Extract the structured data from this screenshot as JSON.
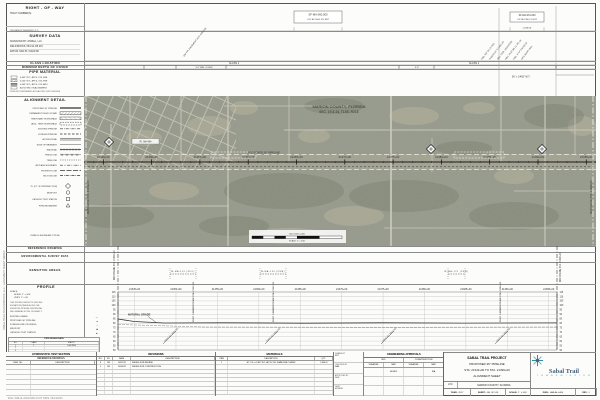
{
  "margin": {
    "left_note": "SABAL TRAIL TRANSMISSION, LLC  -  ALIGNMENT SHEET SERIES",
    "plot_note": "FILE: SAB-AL-0404.DWG    PLOT DATE: 09/14/2015"
  },
  "stations": [
    "21345+00",
    "21350+00",
    "21355+00",
    "21360+00",
    "21365+00",
    "21370+00",
    "21375+00",
    "21380+00",
    "21385+00",
    "21390+00",
    "21395+00"
  ],
  "header": {
    "row": {
      "title": "RIGHT - OF - WAY",
      "sub1": "TRACT NUMBER(S)",
      "sub2": "PERMANENT EASEMENT (FT.)",
      "tract1": "SF-MA-060.000",
      "or1": "O.R. BK 2044, PG 1857",
      "tract2": "SF-MA-061.000",
      "or2": "O.R. BK 1980, PG 0112",
      "dim": "1,318.50'"
    },
    "survey": {
      "title": "SURVEY DATA",
      "rows": [
        "SURVEYED BY: ATWELL, LLC",
        "FIELD BOOKS: FB 214, FB 215",
        "DATUM: NAD 83 / NAVD 88"
      ],
      "slants": [
        {
          "x": 100,
          "y": 54,
          "t": "100' FPL EASEMENT (O.R. 845/123)"
        },
        {
          "x": 398,
          "y": 57,
          "t": "FND. 5/8\" IR LS 7011"
        },
        {
          "x": 406,
          "y": 57,
          "t": "N 89°54'12\" E  2,651.20'"
        },
        {
          "x": 414,
          "y": 57,
          "t": "SEC. COR. 19/24/25/30"
        },
        {
          "x": 422,
          "y": 57,
          "t": "REC. PLAT BK 12, PG 34"
        },
        {
          "x": 430,
          "y": 57,
          "t": "FND. 4\"X4\" CM NO ID"
        },
        {
          "x": 438,
          "y": 57,
          "t": "GPS POINT 4041"
        }
      ],
      "rows_right": ""
    },
    "class_location": {
      "title": "CLASS LOCATION",
      "note": "CLASS 1"
    },
    "min_depth": {
      "title": "MINIMUM DEPTH OF COVER",
      "seg_label": "3'-0\" MIN. COVER",
      "tick_label": "4'-0\"",
      "ticks": [
        60,
        92,
        142,
        315,
        350,
        472
      ]
    },
    "pipe_material": {
      "title": "PIPE MATERIAL",
      "rows": [
        "0.465\" W.T., API 5L X70, FBE",
        "0.540\" W.T., API 5L X70, FBE",
        "0.640\" W.T., API 5L X70, ARO",
        "AS NOTED ON ALIGNMENT"
      ],
      "note": "* DOES NOT REPRESENT ACTUAL PIPE JOINT LENGTHS",
      "right_label": "36\" x 0.465\" W.T."
    }
  },
  "alignment_detail": {
    "title": "ALIGNMENT DETAIL",
    "items": [
      [
        "PROPOSED 36\" PIPELINE",
        "solid"
      ],
      [
        "PERMANENT RIGHT-OF-WAY",
        "hatch"
      ],
      [
        "TEMPORARY WORKSPACE",
        "hatch2"
      ],
      [
        "ADDL. TEMP. WORKSPACE",
        "dashbox"
      ],
      [
        "EXISTING PIPELINE",
        "dashdot"
      ],
      [
        "FOREIGN PIPELINE",
        "dash"
      ],
      [
        "ACCESS ROAD",
        "double"
      ],
      [
        "EDGE OF PAVEMENT",
        "thin"
      ],
      [
        "RAILROAD",
        "rail"
      ],
      [
        "FENCE LINE",
        "xline"
      ],
      [
        "TREE LINE",
        "dots"
      ],
      [
        "WETLAND BOUNDARY",
        "dashdotdot"
      ],
      [
        "PROPERTY LINE",
        "longdash"
      ],
      [
        "SECTION LINE",
        "dashdot"
      ]
    ],
    "symbols": [
      [
        "P.I. (PT. OF INTERSECTION)",
        "diamond"
      ],
      [
        "MILEPOST",
        "circle"
      ],
      [
        "CATHODIC TEST STATION",
        "square"
      ],
      [
        "PIPELINE MARKER",
        "triangle"
      ]
    ],
    "note": "SYMBOLS SHOWN ARE TYPICAL"
  },
  "mid": {
    "reference_drawing": "REFERENCE DRAWING",
    "env_survey": "ENVIRONMENTAL SURVEY DATA",
    "sensitive": "SENSITIVE AREAS",
    "segments": [
      {
        "x1": 86,
        "x2": 112,
        "t": "W-MA-119 (PFO)"
      },
      {
        "x1": 176,
        "x2": 202,
        "t": "W-MA-120 (PEM)"
      },
      {
        "x1": 364,
        "x2": 381,
        "t": "W-MA-121 (PEM)"
      }
    ]
  },
  "map": {
    "county1": "MARION COUNTY, FLORIDA",
    "county2": "SEC. 19 & 24, T15S, R21E",
    "pl_label": "PROPOSED 36\" PIPELINE",
    "pi_label": "P.I. MA-404",
    "scalebar": {
      "above": "500       0       500      1,000",
      "below": "SCALE: 1\" = 500'"
    },
    "matchline_left": "MATCHLINE STA. 21343+00",
    "matchline_right": "MATCHLINE STA. 21396+00"
  },
  "profile": {
    "title": "PROFILE",
    "scale1": "SCALE:",
    "scale2": "HORIZ: 1\" = 500'",
    "scale3": "VERT:  1\" = 50'",
    "note_lines": [
      "THIS PROFILE REFLECTS GROUND",
      "ELEVATIONS TAKEN ALONG THE",
      "SURVEYED PIPELINE CENTERLINE.",
      "SEE GENERAL NOTES ON SHEET 1."
    ],
    "legend": [
      [
        "EXISTING GRADE",
        "line"
      ],
      [
        "PROPOSED 36\" PIPELINE",
        "dot"
      ],
      [
        "FOREIGN LINE CROSSING",
        "circle"
      ],
      [
        "MILEPOST",
        "square"
      ],
      [
        "CATHODIC TEST STATION",
        "tri"
      ]
    ],
    "elev": [
      115,
      110,
      105,
      100,
      95,
      90,
      85,
      80,
      75,
      70,
      65,
      60,
      55,
      50
    ],
    "natural_grade": "NATURAL GRADE",
    "matchline_left": "MATCHLINE STA. 21343+00",
    "matchline_right": "MATCHLINE STA. 21396+00",
    "vert_notes": [
      {
        "x": 109,
        "t": "EXIST. UNPAVED ROAD STA. 21352+00"
      },
      {
        "x": 189,
        "t": "EXIST. UNPAVED ROAD STA. 21362+00"
      },
      {
        "x": 416,
        "t": "EXIST. UNPAVED ROAD STA. 21389+00"
      }
    ],
    "diag_notes": [
      {
        "x": 87,
        "t": "PROP. 36\" PIPELINE"
      },
      {
        "x": 189,
        "t": "PROP. 36\" PIPELINE"
      },
      {
        "x": 305,
        "t": "PROP. 36\" PIPELINE"
      },
      {
        "x": 419,
        "t": "PROP. 36\" PIPELINE"
      }
    ]
  },
  "tables": {
    "pipe_table": {
      "title": "PIPE DESIGN DATA",
      "cols": [
        "NO.",
        "CLASS",
        "M.A.O.P."
      ],
      "rows": [
        [
          "1",
          "1",
          "1,440 PSIG"
        ],
        [
          "2",
          "",
          ""
        ],
        [
          "3",
          "",
          ""
        ]
      ]
    },
    "hydro": {
      "title": "HYDROSTATIC TEST SECTION",
      "sub": "REFERENCE DRAWINGS",
      "cols": [
        "DWG. NO.",
        "DESCRIPTION"
      ],
      "empty_rows": 6
    },
    "revisions": {
      "title": "REVISIONS",
      "cols": [
        "NO.",
        "BY",
        "DATE",
        "DESCRIPTION"
      ],
      "rows": [
        [
          "0",
          "JM",
          "04/17/15",
          "ISSUED FOR REVIEW"
        ],
        [
          "1",
          "JM",
          "09/14/15",
          "ISSUED FOR CONSTRUCTION"
        ]
      ],
      "total_rows": 8
    },
    "materials": {
      "title": "MATERIALS",
      "cols": [
        "ITEM",
        "DESCRIPTION",
        "QTY."
      ],
      "rows": [
        [
          "1",
          "36\" O.D. x 0.465\" W.T., API 5L X70, DSAW, FBE COATED",
          "5,300 LF"
        ]
      ],
      "total_rows": 8
    },
    "approvals": {
      "title": "ENGINEERING APPROVALS",
      "groups": [
        "BID",
        "CONSTRUCTION"
      ],
      "sub": [
        "SIGNATURE",
        "DATE",
        "SIGNATURE",
        "DATE"
      ],
      "left": [
        [
          "DRAWN BY",
          "MJT"
        ],
        [
          "CHECKED BY",
          "RAH"
        ],
        [
          "APPROVED BY",
          "DLW"
        ],
        [
          "DATE",
          "09/14/15"
        ]
      ],
      "cells": [
        [
          "",
          "09/14/15",
          "",
          "N/A"
        ],
        [
          "",
          "",
          "",
          ""
        ],
        [
          "",
          "",
          "",
          ""
        ]
      ]
    }
  },
  "title_block": {
    "l1": "SABAL TRAIL PROJECT",
    "l2": "PROPOSED 36\" PIPELINE",
    "l3": "STA. 21343+00 TO STA. 21396+00",
    "l4": "ALIGNMENT SHEET",
    "loc_label": "LOC:",
    "loc": "MARION COUNTY, FLORIDA",
    "brand": "Sabal Trail",
    "brand_sub": "T R A N S M I S S I O N",
    "cells": [
      [
        "YEAR:",
        "2017"
      ],
      [
        "SHEET:",
        "404 OF 516"
      ],
      [
        "SCALE:",
        "1\" = 500'"
      ],
      [
        "DWG:",
        "SAB-AL-0404"
      ],
      [
        "REV:",
        "1"
      ]
    ]
  }
}
